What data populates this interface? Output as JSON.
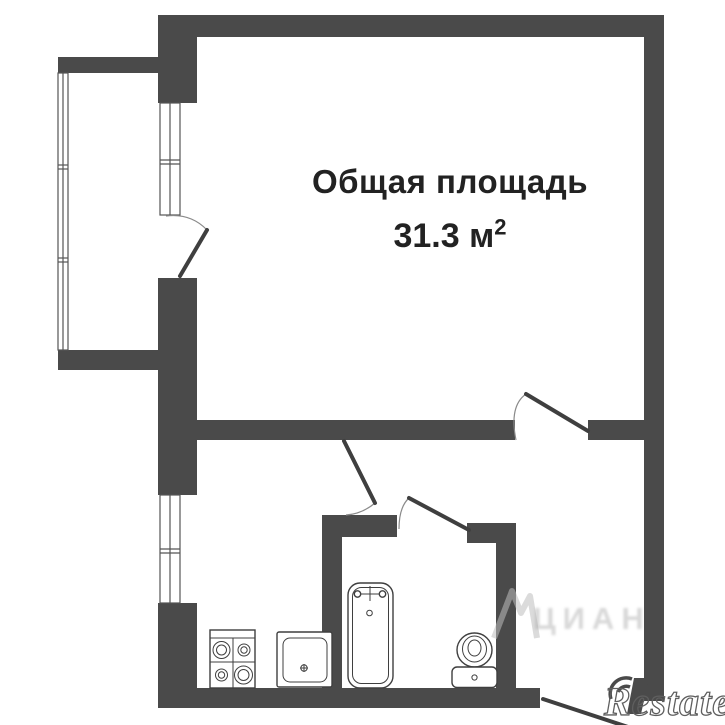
{
  "label": {
    "title": "Общая площадь",
    "area_value": "31.3",
    "area_unit": " м",
    "area_sup": "2"
  },
  "watermarks": {
    "restate": "Restate",
    "cian": "ЦИАН"
  },
  "colors": {
    "wall": "#4a4a4a",
    "door_line": "#3f3f3f",
    "outline": "#3f3f3f",
    "window_line": "#555555",
    "text": "#222222",
    "background": "#ffffff",
    "watermark_gray": "#a8a8a8"
  },
  "icons": [
    "stove-icon",
    "sink-icon",
    "bathtub-icon",
    "toilet-icon",
    "window-symbol",
    "door-swing",
    "restate-logo-icon",
    "cian-peak-icon"
  ]
}
